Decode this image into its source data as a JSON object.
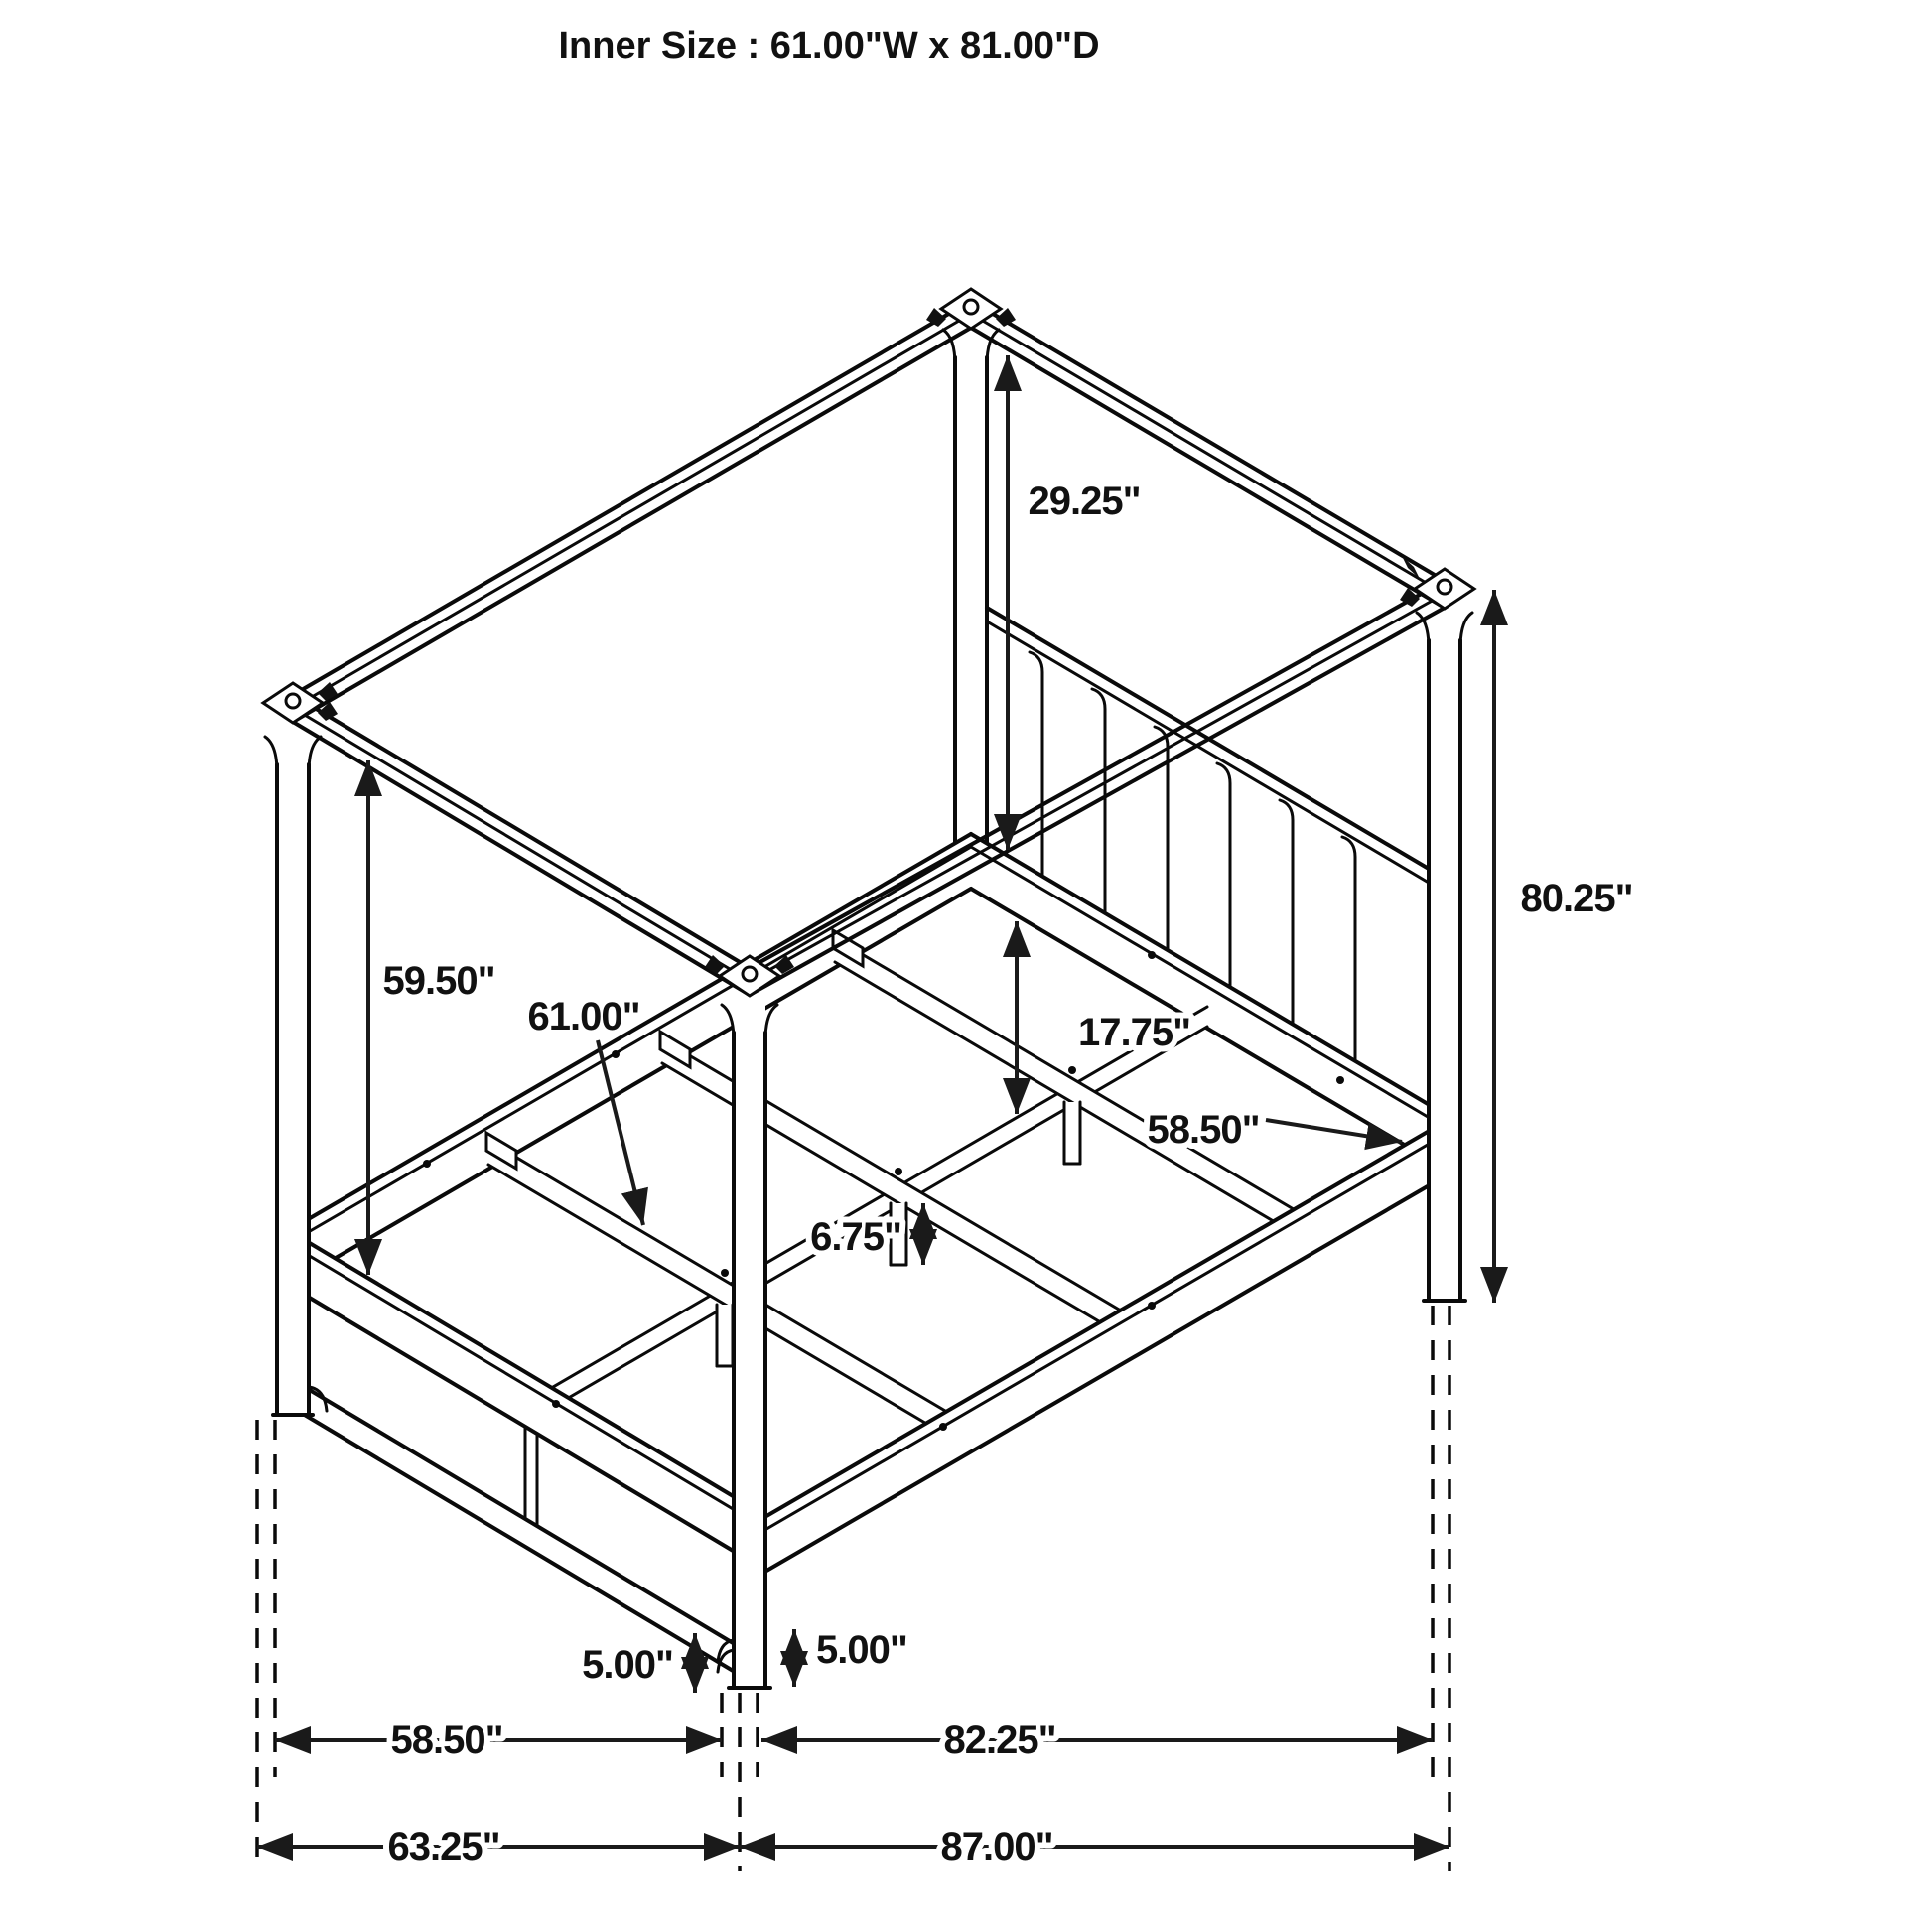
{
  "title": "Inner Size : 61.00\"W x 81.00\"D",
  "figure": {
    "kind": "furniture dimension line drawing",
    "subject": "four-poster canopy bed frame, isometric view"
  },
  "annotations": [
    {
      "id": "canopy-to-headboard-height",
      "label": "29.25\""
    },
    {
      "id": "post-total-height",
      "label": "80.25\""
    },
    {
      "id": "canopy-to-footboard-height",
      "label": "59.50\""
    },
    {
      "id": "slat-length",
      "label": "61.00\""
    },
    {
      "id": "headboard-rail-to-slat-rail",
      "label": "17.75\""
    },
    {
      "id": "headboard-inner-width",
      "label": "58.50\""
    },
    {
      "id": "slat-leg-height",
      "label": "6.75\""
    },
    {
      "id": "footboard-clearance",
      "label": "5.00\""
    },
    {
      "id": "post-clearance",
      "label": "5.00\""
    },
    {
      "id": "inner-width-bottom",
      "label": "58.50\""
    },
    {
      "id": "rail-length-bottom",
      "label": "82.25\""
    },
    {
      "id": "overall-width",
      "label": "63.25\""
    },
    {
      "id": "overall-depth",
      "label": "87.00\""
    }
  ]
}
